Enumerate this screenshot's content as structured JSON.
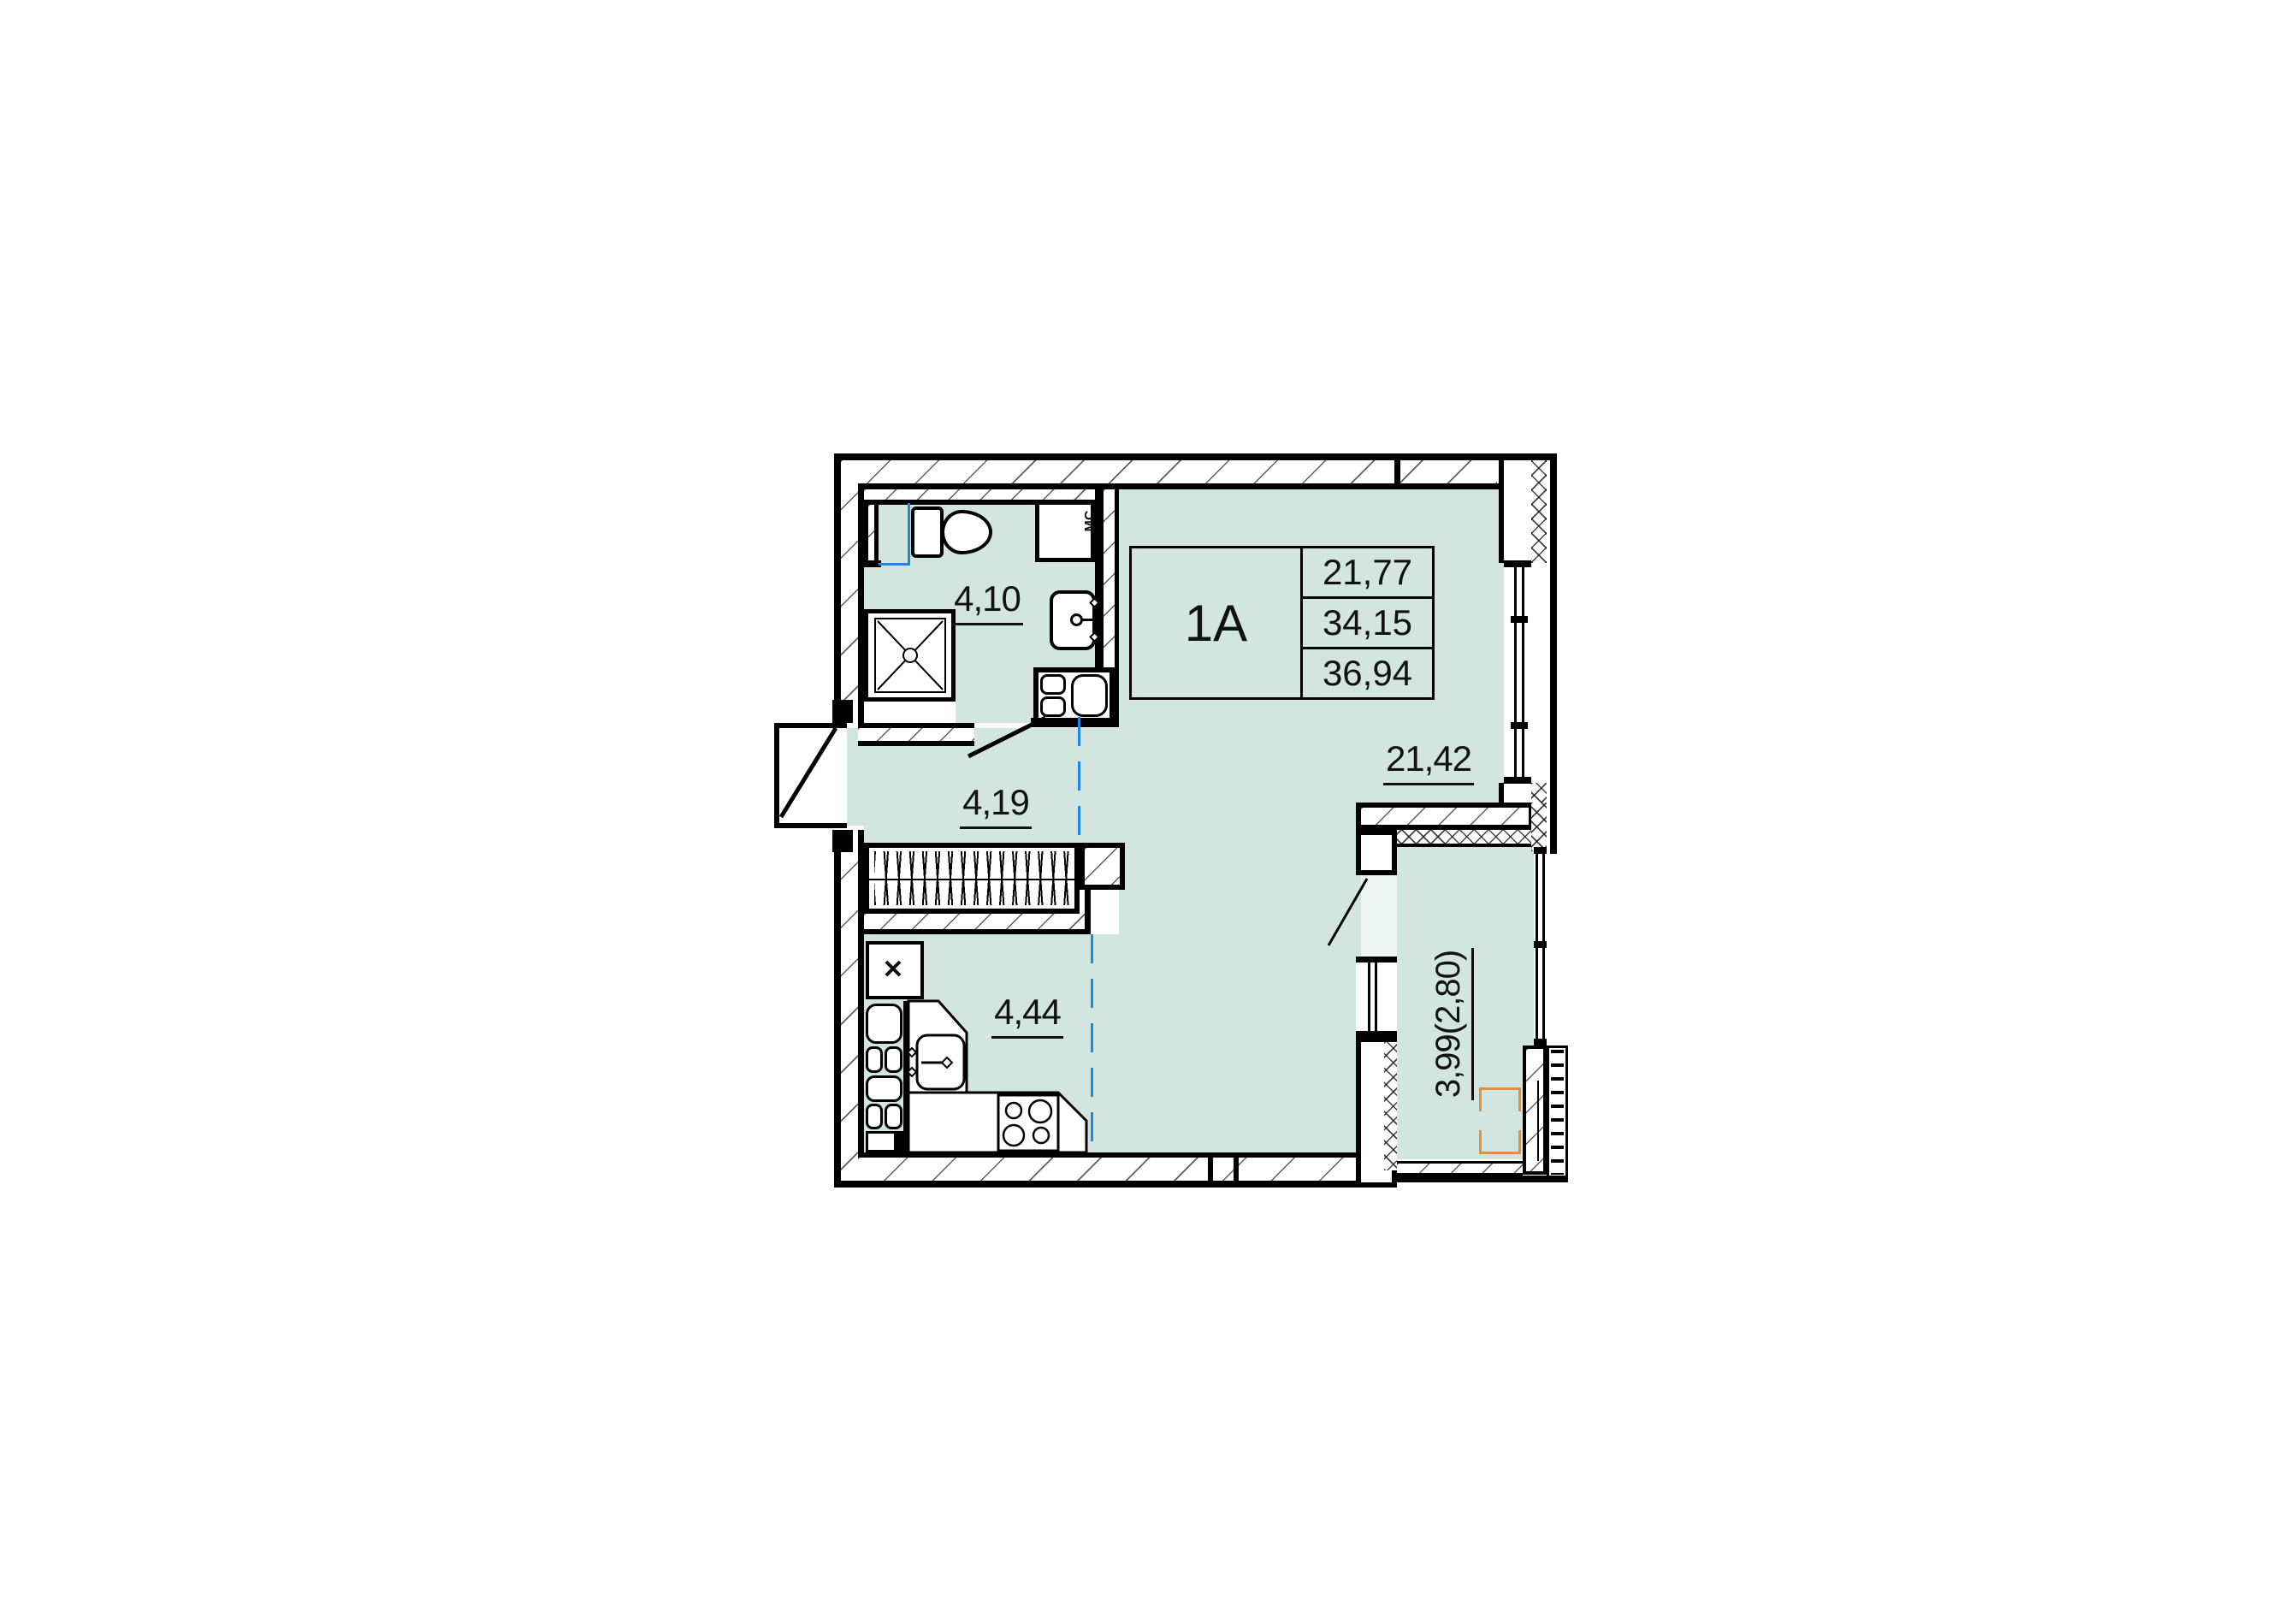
{
  "plan": {
    "unit": {
      "label": "1A"
    },
    "area_table": {
      "values": [
        "21,77",
        "34,15",
        "36,94"
      ]
    },
    "rooms": {
      "bathroom": "4,10",
      "hall": "4,19",
      "kitchen": "4,44",
      "living": "21,42",
      "balcony": "3,99(2,80)"
    },
    "annotations": {
      "washing_machine": "МС",
      "vent_cross": "✕"
    }
  },
  "colors": {
    "floor": "#d2e5df",
    "axis_blue": "#1e87e6",
    "highlight_orange": "#e2903c",
    "wall": "#000000"
  }
}
